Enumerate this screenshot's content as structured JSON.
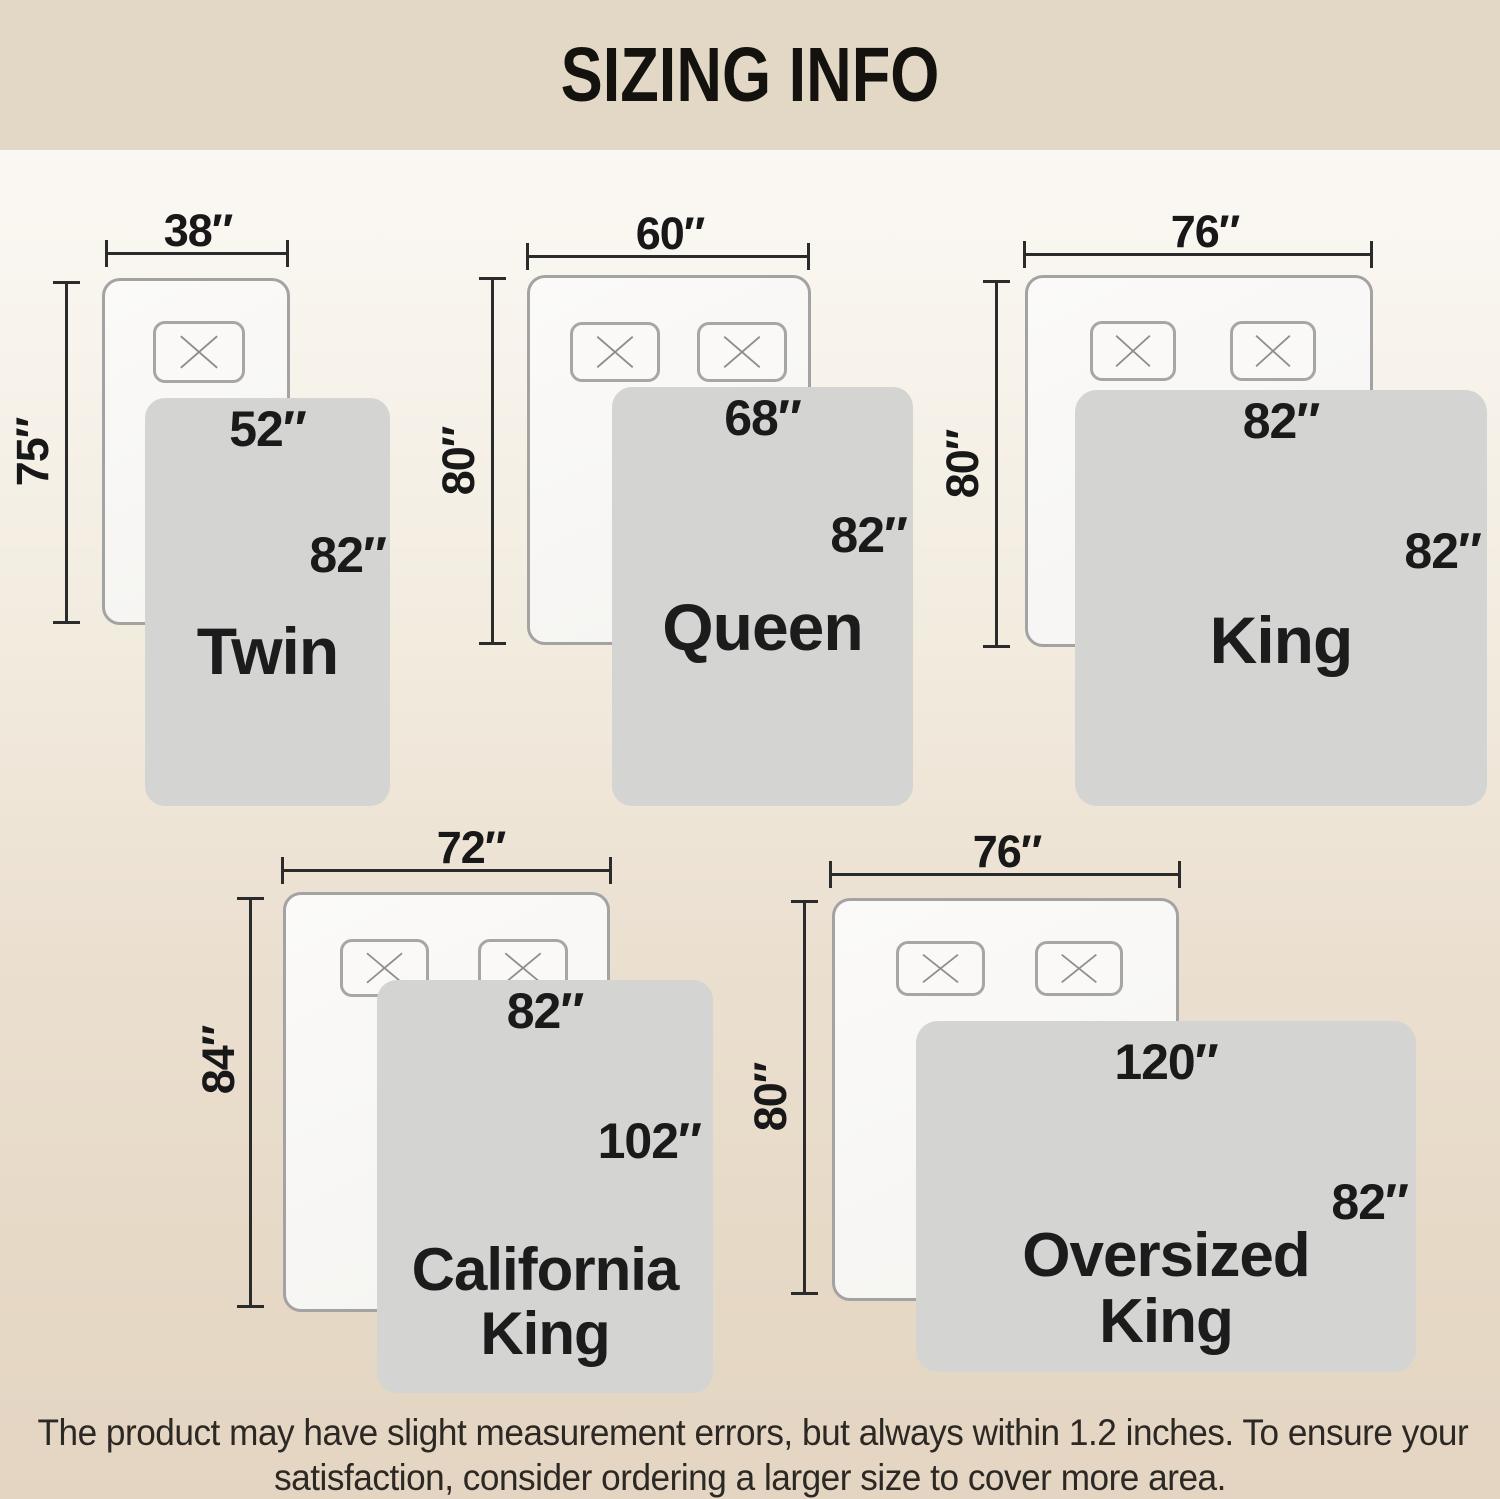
{
  "header": {
    "title": "SIZING INFO"
  },
  "colors": {
    "header_bg": "#e2d8c5",
    "background_top": "#fcfbf9",
    "background_bottom": "#e3d5c2",
    "blanket_fill": "#d4d4d3",
    "bed_fill": "#f7f6f3",
    "bed_border": "#a3a3a3",
    "dimension_line": "#2b2b2b",
    "text": "#1a1a1a"
  },
  "sizes": [
    {
      "name": "Twin",
      "name_lines": [
        "Twin"
      ],
      "bed_width": "38″",
      "bed_length": "75″",
      "blanket_width": "52″",
      "blanket_length": "82″",
      "pillows": 1
    },
    {
      "name": "Queen",
      "name_lines": [
        "Queen"
      ],
      "bed_width": "60″",
      "bed_length": "80″",
      "blanket_width": "68″",
      "blanket_length": "82″",
      "pillows": 2
    },
    {
      "name": "King",
      "name_lines": [
        "King"
      ],
      "bed_width": "76″",
      "bed_length": "80″",
      "blanket_width": "82″",
      "blanket_length": "82″",
      "pillows": 2
    },
    {
      "name": "California King",
      "name_lines": [
        "California",
        "King"
      ],
      "bed_width": "72″",
      "bed_length": "84″",
      "blanket_width": "82″",
      "blanket_length": "102″",
      "pillows": 2
    },
    {
      "name": "Oversized King",
      "name_lines": [
        "Oversized",
        "King"
      ],
      "bed_width": "76″",
      "bed_length": "80″",
      "blanket_width": "120″",
      "blanket_length": "82″",
      "pillows": 2
    }
  ],
  "footer": {
    "lines": [
      "The product may have slight measurement errors, but always within 1.2 inches. To ensure your",
      "satisfaction, consider ordering a larger size to cover more area."
    ]
  }
}
